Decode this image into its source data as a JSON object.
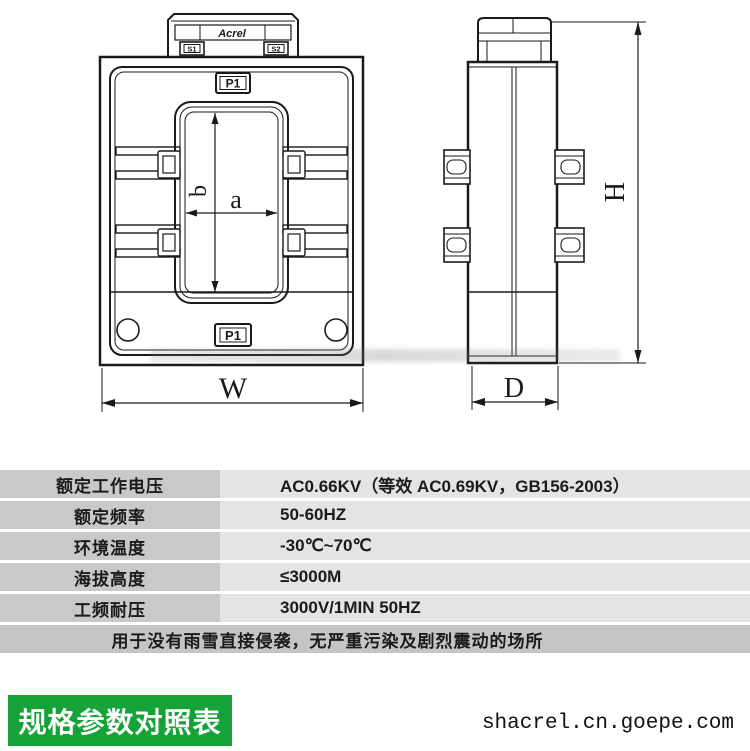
{
  "drawing": {
    "front_view": {
      "logo": "Acrel",
      "terminal_left": "S1",
      "terminal_right": "S2",
      "label_top": "P1",
      "label_bottom": "P1",
      "dim_a": "a",
      "dim_b": "b",
      "dim_w": "W"
    },
    "side_view": {
      "dim_h": "H",
      "dim_d": "D"
    }
  },
  "spec_table": {
    "rows": [
      {
        "label": "额定工作电压",
        "value": "AC0.66KV（等效 AC0.69KV，GB156-2003）"
      },
      {
        "label": "额定频率",
        "value": "50-60HZ"
      },
      {
        "label": "环境温度",
        "value": "-30℃~70℃"
      },
      {
        "label": "海拔高度",
        "value": "≤3000M"
      },
      {
        "label": "工频耐压",
        "value": "3000V/1MIN 50HZ"
      }
    ],
    "note": "用于没有雨雪直接侵袭，无严重污染及剧烈震动的场所"
  },
  "footer": {
    "badge": "规格参数对照表",
    "watermark": "shacrel.cn.goepe.com"
  },
  "colors": {
    "badge_green": "#15a237",
    "table_label_bg": "#c9c9c9",
    "table_value_bg": "#e4e4e4",
    "table_note_bg": "#c5c5c5",
    "text": "#1b1b1b"
  }
}
